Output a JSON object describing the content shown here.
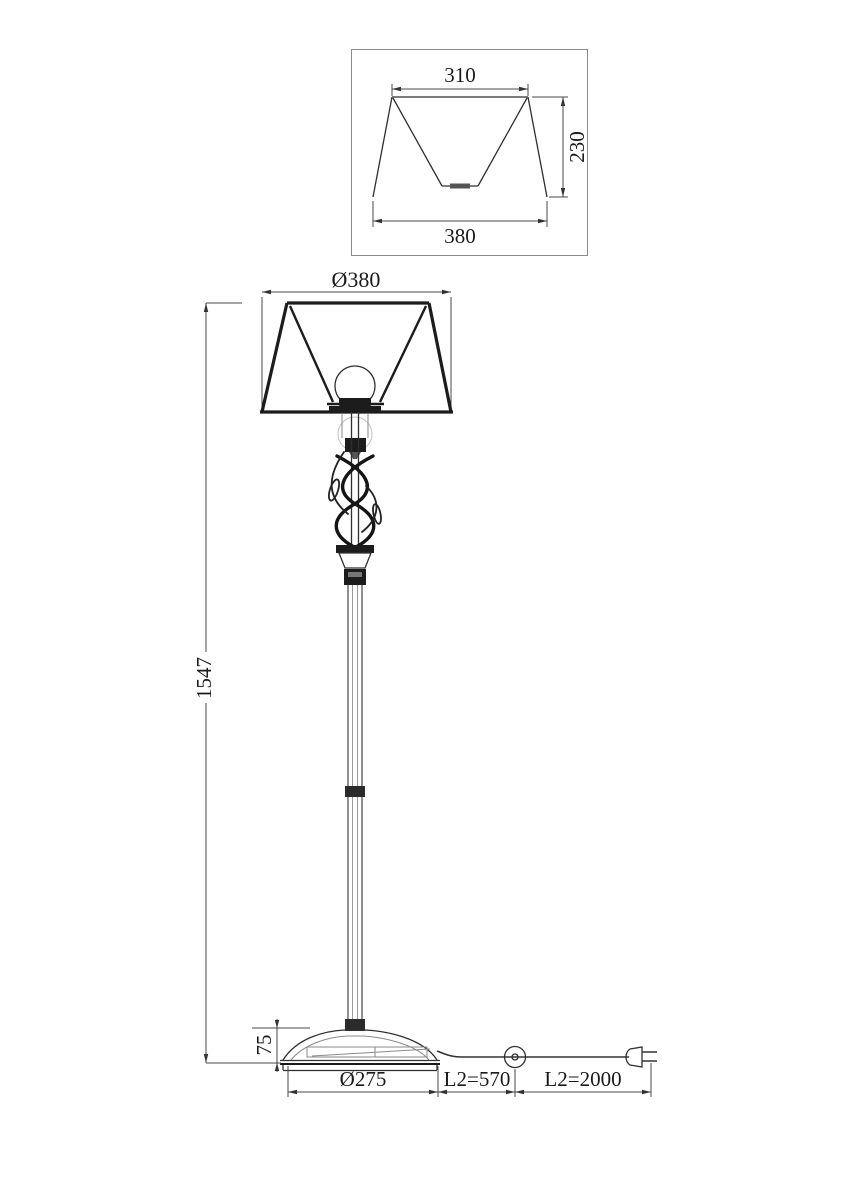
{
  "detail_view": {
    "top_width": "310",
    "height": "230",
    "bottom_width": "380"
  },
  "main_view": {
    "shade_diameter": "Ø380",
    "total_height": "1547",
    "base_height": "75",
    "base_diameter": "Ø275",
    "cord_length_to_switch": "L2=570",
    "cord_length_to_plug": "L2=2000"
  },
  "colors": {
    "line_dark": "#1c1c1c",
    "line_medium": "#3a3a3a",
    "line_light": "#8a8a8a",
    "background": "#ffffff"
  }
}
